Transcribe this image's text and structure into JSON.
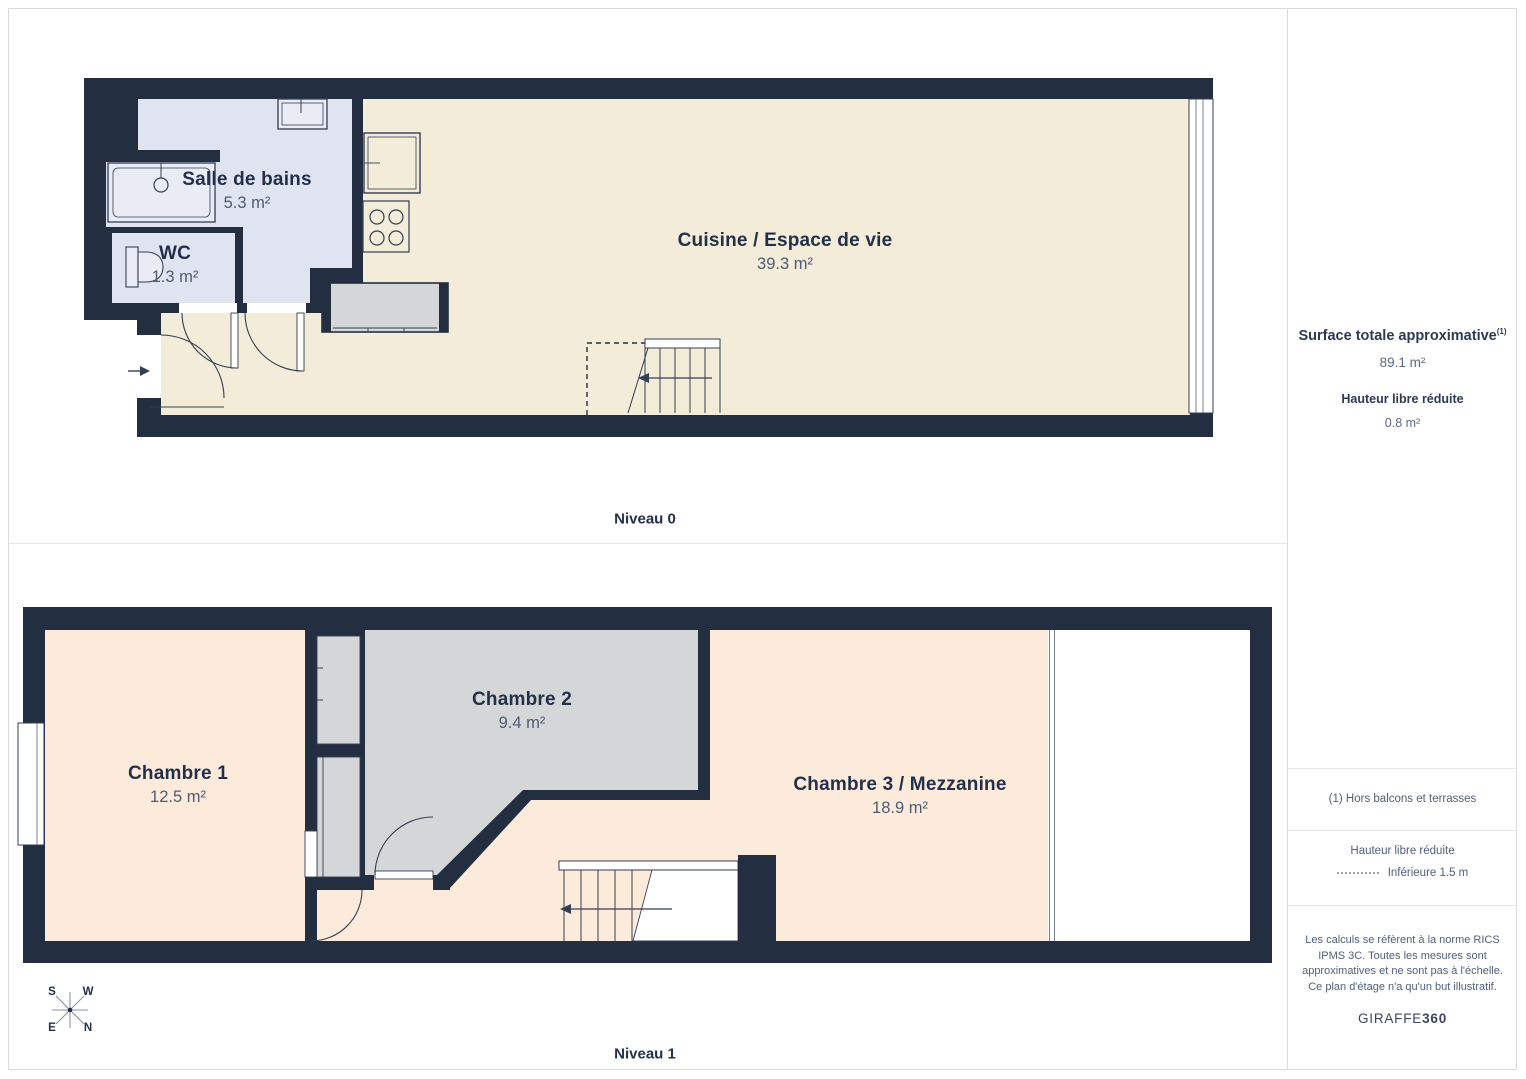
{
  "colors": {
    "wall": "#232e41",
    "floor_living": "#f2ecd8",
    "floor_bedroom": "#fcebdb",
    "floor_bathroom": "#dfe4f0",
    "floor_chambre2": "#d5d6d7",
    "text_primary": "#22304a",
    "text_muted": "#4e5b73",
    "sidebar_muted": "#5d6b82"
  },
  "levels": [
    {
      "label": "Niveau 0",
      "rooms": [
        {
          "name": "Salle de bains",
          "area": "5.3 m²"
        },
        {
          "name": "WC",
          "area": "1.3 m²"
        },
        {
          "name": "Cuisine / Espace de vie",
          "area": "39.3 m²"
        }
      ]
    },
    {
      "label": "Niveau 1",
      "rooms": [
        {
          "name": "Chambre 1",
          "area": "12.5 m²"
        },
        {
          "name": "Chambre 2",
          "area": "9.4 m²"
        },
        {
          "name": "Chambre 3 / Mezzanine",
          "area": "18.9 m²"
        }
      ]
    }
  ],
  "sidebar": {
    "surface_title": "Surface totale approximative",
    "surface_footnote_marker": "(1)",
    "surface_value": "89.1 m²",
    "reduced_height_title": "Hauteur libre réduite",
    "reduced_height_value": "0.8 m²",
    "footnote": "(1) Hors balcons et terrasses",
    "legend_title": "Hauteur libre réduite",
    "legend_value": "Inférieure 1.5 m",
    "disclaimer": "Les calculs se réfèrent à la norme RICS IPMS 3C. Toutes les mesures sont approximatives et ne sont pas à l'échelle. Ce plan d'étage n'a qu'un but illustratif.",
    "brand_name": "GIRAFFE",
    "brand_suffix": "360"
  },
  "compass": {
    "top_left": "S",
    "top_right": "W",
    "bottom_left": "E",
    "bottom_right": "N"
  }
}
